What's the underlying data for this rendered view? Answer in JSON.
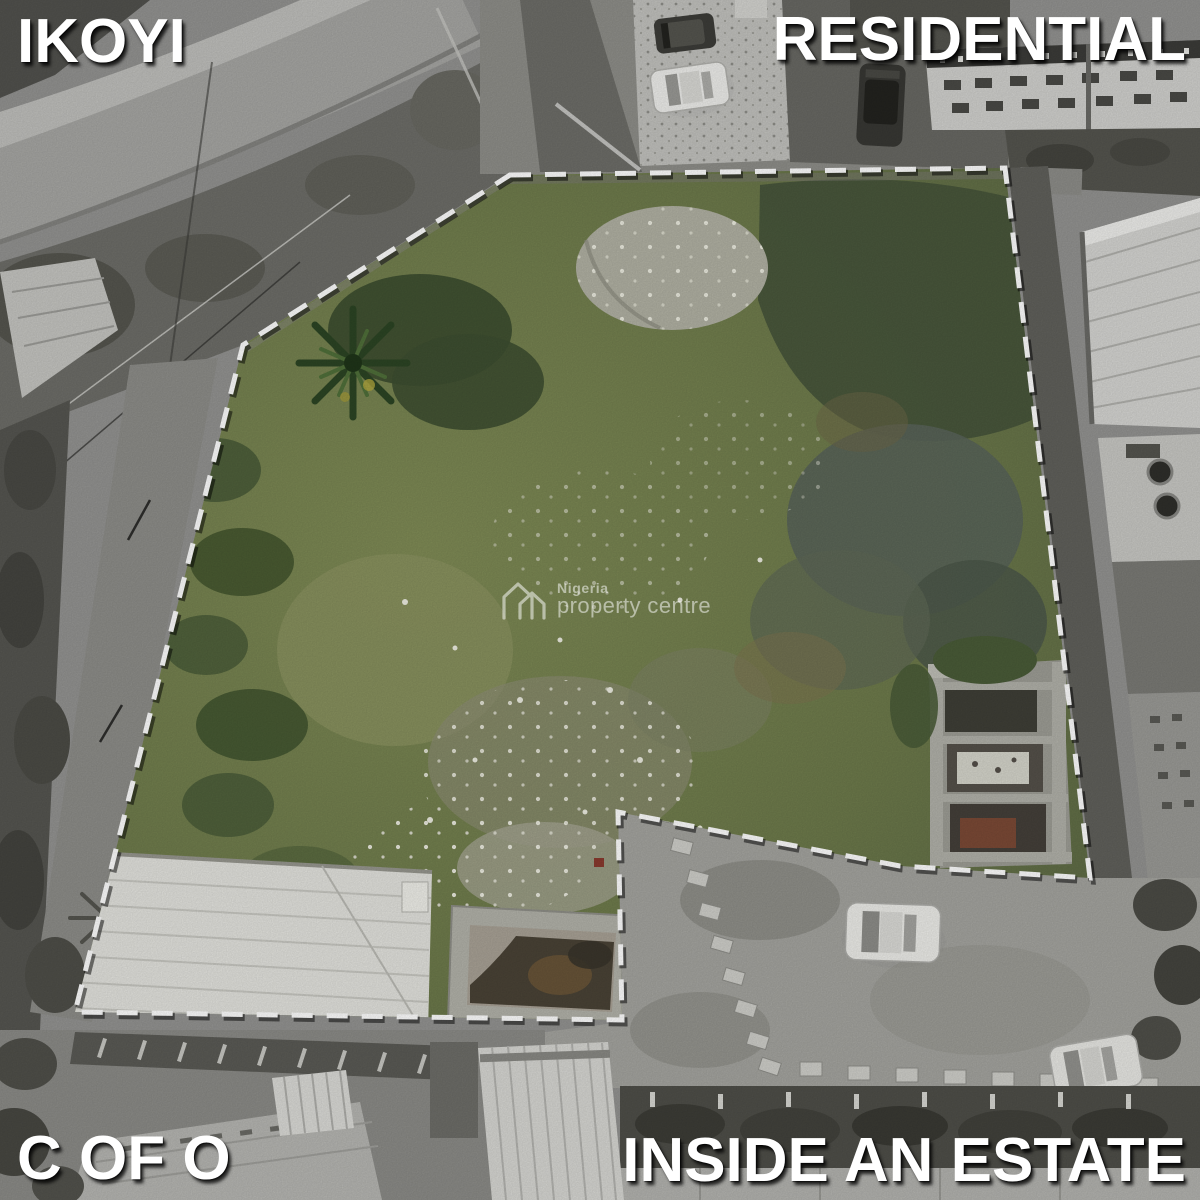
{
  "overlay_labels": {
    "top_left": "IKOYI",
    "top_right": "RESIDENTIAL",
    "bottom_left": "C OF O",
    "bottom_right": "INSIDE AN ESTATE"
  },
  "watermark": {
    "brand_top": "Nigeria",
    "brand_bottom": "property centre",
    "logo_icon": "npc-double-house-logo-icon"
  },
  "colors": {
    "label_text": "#ffffff",
    "label_shadow": "rgba(0,0,0,0.78)",
    "boundary_dash": "#ffffff",
    "boundary_dash_shadow": "rgba(0,0,0,0.5)",
    "plot_green_light": "#808c56",
    "plot_green_base": "#6d7a4b",
    "plot_green_dark": "#46553b",
    "surroundings_gray": "#949492",
    "roof_white": "#e4e4df",
    "rust_brown": "#7c4a36"
  }
}
